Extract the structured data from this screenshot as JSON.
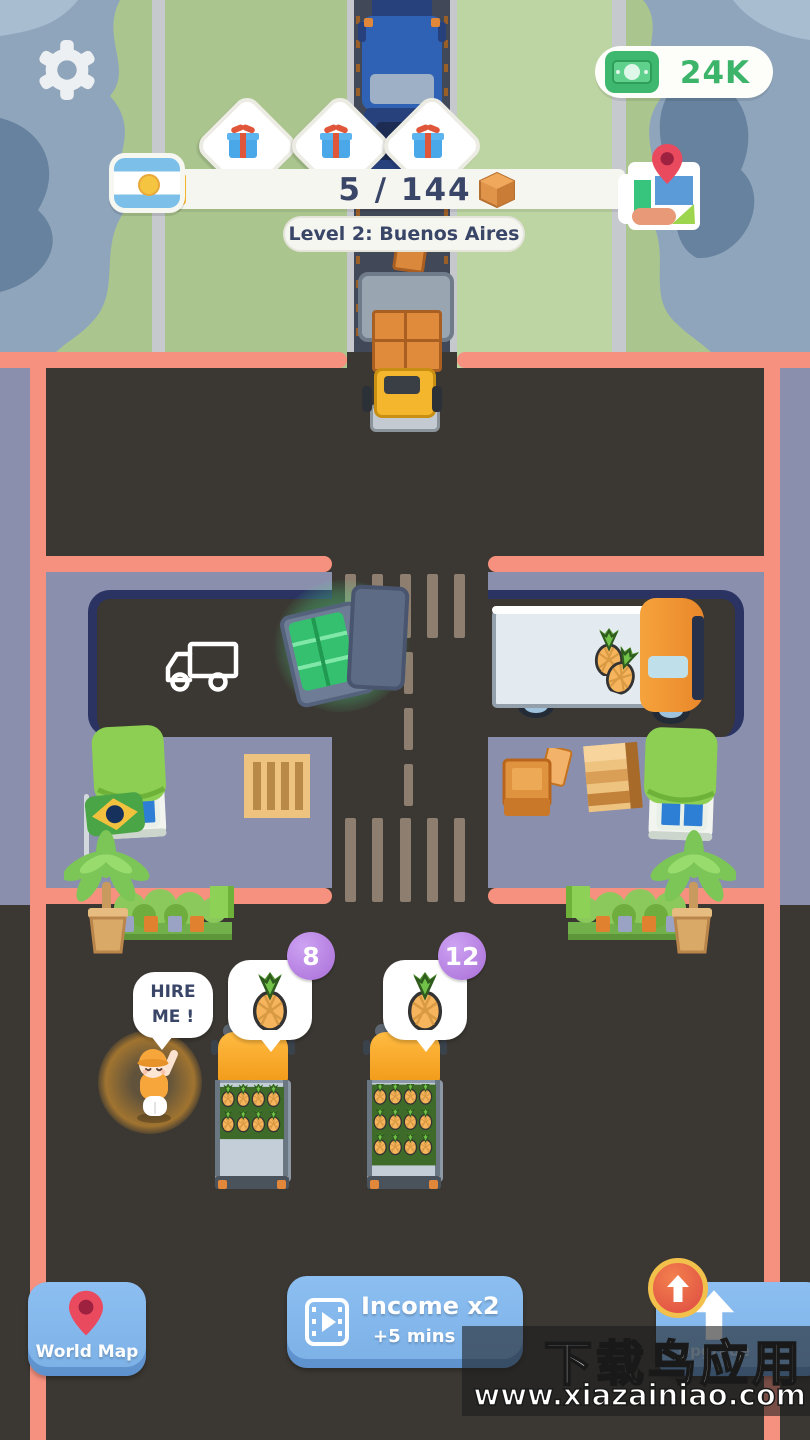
{
  "colors": {
    "money_green": "#3cb56b",
    "wall_salmon": "#f6917f",
    "lot_lavender": "#8a8fae",
    "asphalt": "#3b3732",
    "button_blue": "#84b8ec",
    "badge_purple": "#b583e3",
    "hud_text_navy": "#3a4668",
    "cab_orange": "#f6a62e"
  },
  "hud": {
    "money": "24K",
    "progress_text": "5 / 144",
    "level_label": "Level 2: Buenos Aires",
    "gift_milestones": 3,
    "icons": {
      "settings": "gear-icon",
      "money": "cash-icon",
      "flag": "argentina-flag-icon",
      "milestone": "gift-icon",
      "shipment": "package-icon",
      "minimap": "map-thumbnail-icon"
    }
  },
  "scene": {
    "hire_prompt_line1": "HIRE",
    "hire_prompt_line2": "ME !",
    "cargo_bubbles": [
      {
        "item": "pineapple",
        "count": "8"
      },
      {
        "item": "pineapple",
        "count": "12"
      }
    ],
    "icons": {
      "empty_slot": "truck-outline-icon",
      "reward": "money-briefcase-icon",
      "cargo": "pineapple-icon",
      "worker": "hire-worker-character"
    }
  },
  "footer": {
    "world_map_label": "World Map",
    "income_line1": "Income x2",
    "income_line2": "+5 mins",
    "upgrade_label": "Upgrade",
    "icons": {
      "world_map": "map-pin-icon",
      "income": "ad-video-icon",
      "upgrade": "up-arrow-icon"
    }
  },
  "watermark": {
    "line1": "下载鸟应用",
    "line2": "www.xiazainiao.com"
  }
}
